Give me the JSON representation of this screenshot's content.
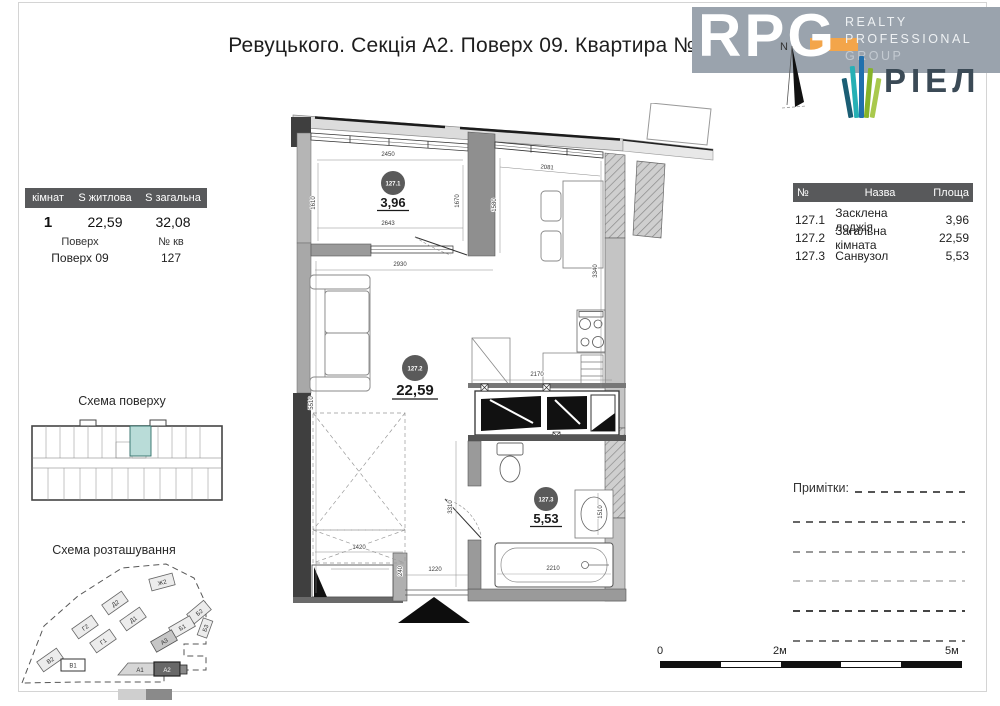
{
  "page": {
    "title": "Ревуцького. Секція А2. Поверх 09. Квартира №127"
  },
  "logo": {
    "rpg": "RPG",
    "realty": "REALTY",
    "professional": "PROFESSIONAL",
    "group": "GROUP",
    "riel": "РІЕЛ",
    "colors": {
      "band": "#9aa3ad",
      "orange": "#f3a54a",
      "teal": "#26b0b5",
      "blue": "#2170ad",
      "green": "#86b32a",
      "dark_teal": "#1b5e74",
      "riel_text": "#3b4a56"
    }
  },
  "compass": {
    "north": "N"
  },
  "left_table": {
    "headers": [
      "кімнат",
      "S житлова",
      "S загальна"
    ],
    "values": [
      "1",
      "22,59",
      "32,08"
    ],
    "floor_label": "Поверх",
    "apt_label": "№ кв",
    "floor_value": "Поверх 09",
    "apt_value": "127"
  },
  "floor_scheme": {
    "title": "Схема поверху",
    "highlight_color": "#b9dcd8"
  },
  "site_scheme": {
    "title": "Схема розташування",
    "highlight": "А2",
    "buildings": [
      {
        "label": "Ж2"
      },
      {
        "label": "Д2"
      },
      {
        "label": "Д1"
      },
      {
        "label": "Б2"
      },
      {
        "label": "Б1"
      },
      {
        "label": "Б3"
      },
      {
        "label": "Г2"
      },
      {
        "label": "Г1"
      },
      {
        "label": "А3"
      },
      {
        "label": "В2"
      },
      {
        "label": "В1"
      },
      {
        "label": "А1"
      },
      {
        "label": "А2"
      }
    ]
  },
  "plan": {
    "rooms": [
      {
        "id": "127.1",
        "area": "3,96"
      },
      {
        "id": "127.2",
        "area": "22,59"
      },
      {
        "id": "127.3",
        "area": "5,53"
      }
    ],
    "dims": {
      "d2450": "2450",
      "d1610": "1610",
      "d1670": "1670",
      "d2643": "2643",
      "d1580": "1580",
      "d2081": "2081",
      "d2930": "2930",
      "d3340": "3340",
      "d2170": "2170",
      "d5510": "5510",
      "d1420": "1420",
      "d240": "240",
      "d1220": "1220",
      "d2210": "2210",
      "d1510": "1510",
      "d3310": "3310"
    }
  },
  "right_table": {
    "headers": [
      "№",
      "Назва",
      "Площа"
    ],
    "rows": [
      [
        "127.1",
        "Засклена лоджія",
        "3,96"
      ],
      [
        "127.2",
        "Загальна кімната",
        "22,59"
      ],
      [
        "127.3",
        "Санвузол",
        "5,53"
      ]
    ]
  },
  "notes": {
    "label": "Примітки:"
  },
  "scale": {
    "zero": "0",
    "two": "2м",
    "five": "5м"
  }
}
